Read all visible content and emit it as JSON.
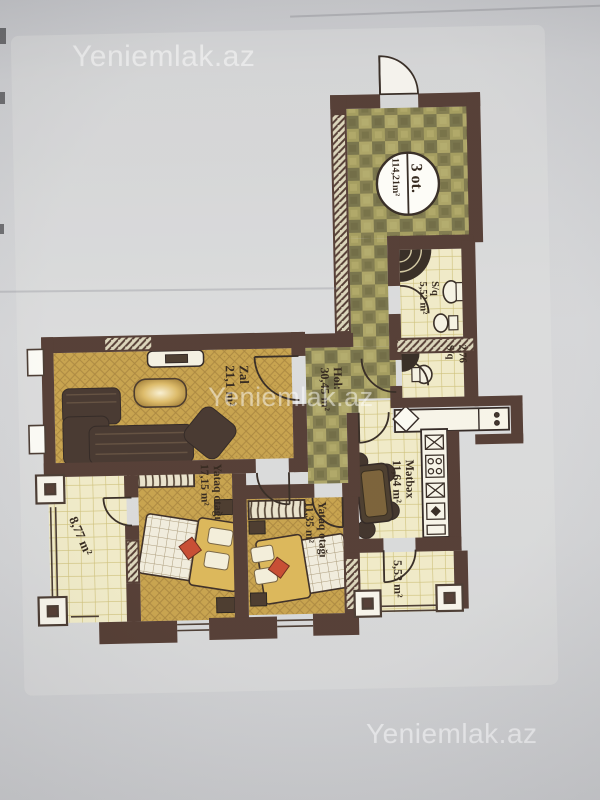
{
  "watermark": {
    "text": "Yeniemlak.az"
  },
  "plan": {
    "badge": {
      "title": "3 ot.",
      "area": "114,21m²"
    },
    "rooms": {
      "zal": {
        "name": "Zal",
        "area": "21,1 m²"
      },
      "hol": {
        "name": "Hol:",
        "area": "30,45 m²"
      },
      "yataq1": {
        "name": "Yataq otağı",
        "area": "17,15 m²"
      },
      "yataq2": {
        "name": "Yataq otağı",
        "area": "11,35 m²"
      },
      "metbex": {
        "name": "Mətbəx",
        "area": "11,64 m²"
      },
      "sq1": {
        "name": "S/q",
        "area": "5,52 m²"
      },
      "sq2": {
        "name": "S/q",
        "area": "2,76"
      },
      "balcony_left": {
        "area": "8,77 m²"
      },
      "balcony_right": {
        "area": "5,53 m²"
      }
    },
    "colors": {
      "wall": "#442b21",
      "gold_floor": "#c29a3c",
      "checker_floor": "#8e874c",
      "tile_floor": "#eee8c2",
      "accent_red": "#c23b1e",
      "paper": "#d5d5d6"
    }
  }
}
